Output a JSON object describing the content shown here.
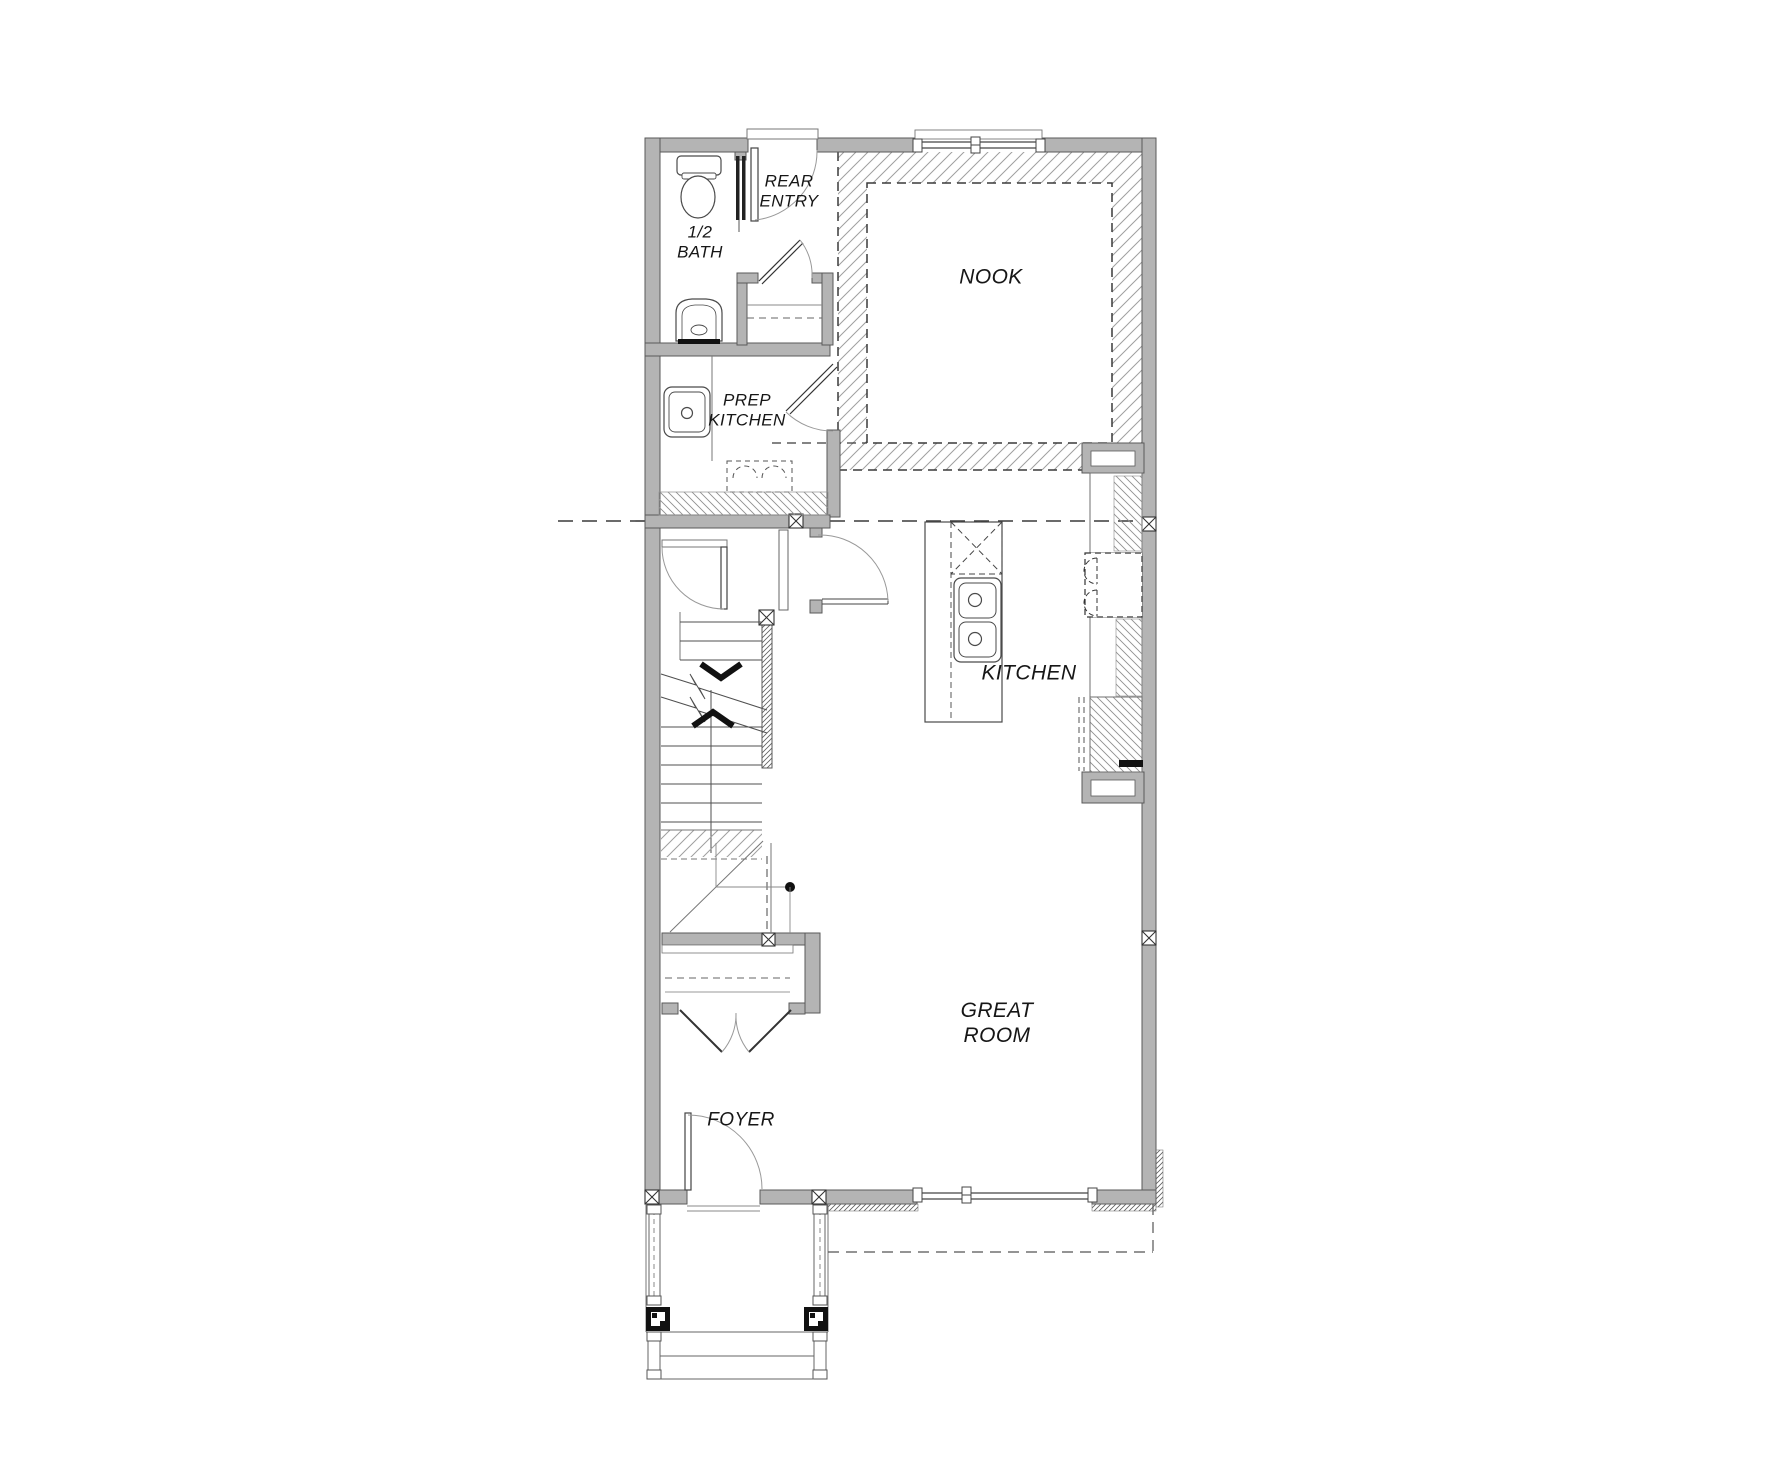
{
  "page": {
    "type": "architectural floor plan",
    "background": "#ffffff"
  },
  "colors": {
    "wall_fill": "#b4b4b4",
    "wall_stroke": "#5a5a5a",
    "line": "#4a4a4a",
    "light_line": "#888888",
    "hatch": "#9a9a9a",
    "text": "#161616"
  },
  "rooms": [
    {
      "id": "half-bath",
      "label": "1/2\nBATH"
    },
    {
      "id": "rear-entry",
      "label": "REAR\nENTRY"
    },
    {
      "id": "nook",
      "label": "NOOK"
    },
    {
      "id": "prep-kitchen",
      "label": "PREP\nKITCHEN"
    },
    {
      "id": "kitchen",
      "label": "KITCHEN"
    },
    {
      "id": "great-room",
      "label": "GREAT\nROOM"
    },
    {
      "id": "foyer",
      "label": "FOYER"
    }
  ],
  "fixtures": [
    "toilet",
    "pedestal-sink",
    "pocket-door",
    "rear-entry-door",
    "coat-closet-shelf",
    "prep-kitchen-sink",
    "undercounter-appliance",
    "kitchen-island",
    "island-double-sink",
    "hood-above-island",
    "range-cooktop",
    "wall-counters",
    "pantry-cabinets",
    "window-niche",
    "stairs-with-break-line",
    "stair-direction-chevrons",
    "under-stair-closet",
    "double-closet-doors",
    "front-door",
    "windows",
    "porch-columns",
    "porch-railings",
    "porch-steps",
    "roof-overhang-outline"
  ]
}
